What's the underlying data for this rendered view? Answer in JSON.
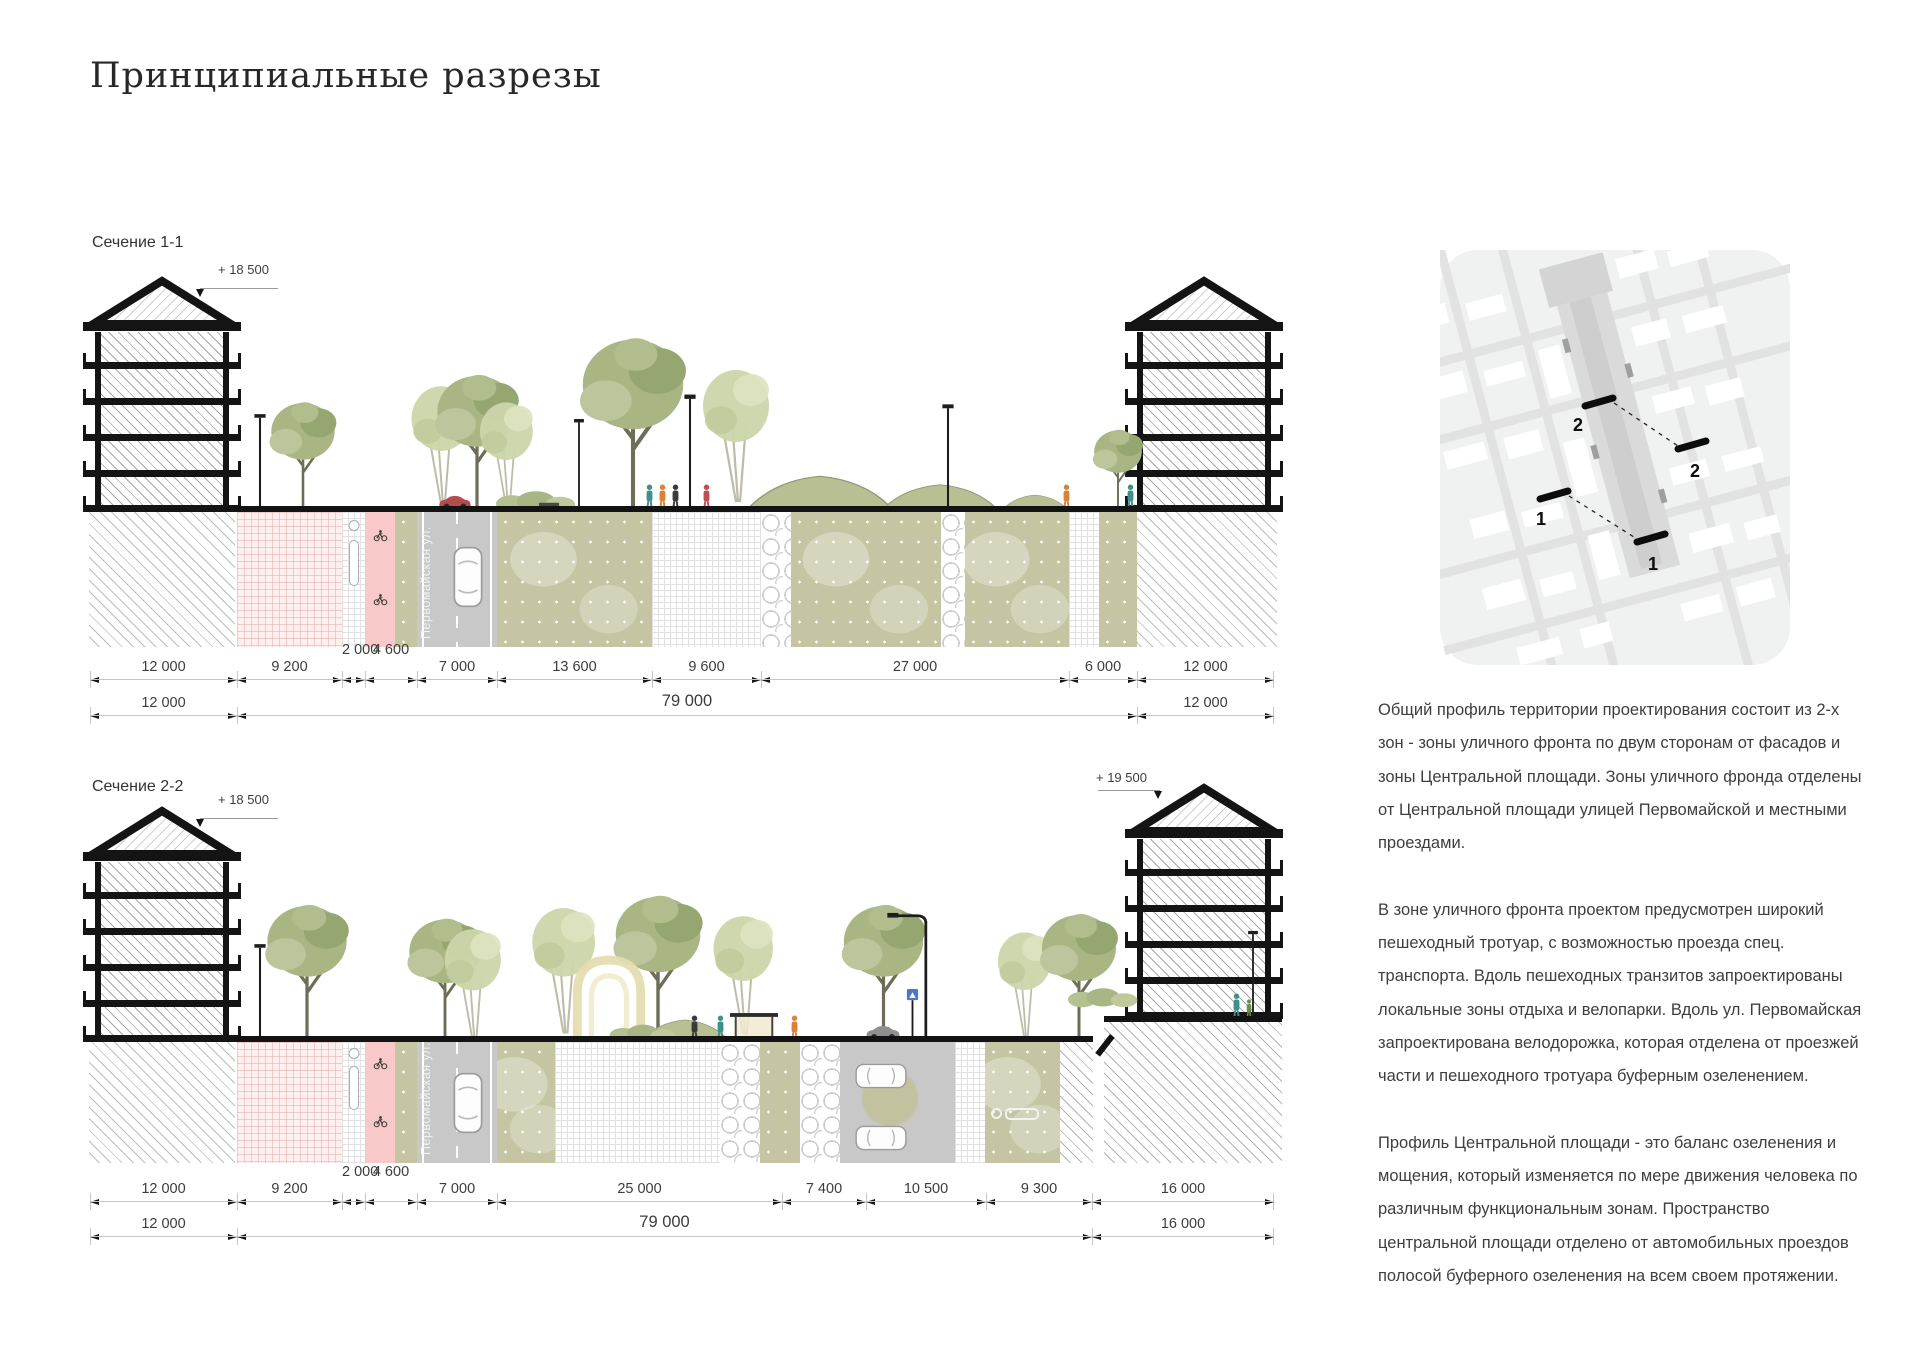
{
  "page": {
    "title": "Принципиальные разрезы"
  },
  "sections": [
    {
      "label": "Сечение 1-1",
      "elevation_left": "+ 18 500",
      "street_label": "Первомайская ул.",
      "dims_row1": [
        "12 000",
        "9 200",
        "2 000",
        "4 600",
        "7 000",
        "13 600",
        "9 600",
        "27 000",
        "6 000",
        "12 000"
      ],
      "dims_row2": [
        "12 000",
        "79 000",
        "12 000"
      ]
    },
    {
      "label": "Сечение 2-2",
      "elevation_left": "+ 18 500",
      "elevation_right": "+ 19 500",
      "street_label": "Первомайская ул.",
      "dims_row1": [
        "12 000",
        "9 200",
        "2 000",
        "4 600",
        "7 000",
        "25 000",
        "7 400",
        "10 500",
        "9 300",
        "16 000"
      ],
      "dims_row2": [
        "12 000",
        "79 000",
        "16 000"
      ]
    }
  ],
  "map": {
    "markers": [
      "2",
      "2",
      "1",
      "1"
    ]
  },
  "text": {
    "paragraphs": [
      "Общий профиль территории проектирования состоит из 2-х зон - зоны уличного фронта по двум сторонам от фасадов и зоны Центральной площади. Зоны уличного фронда отделены от Центральной площади улицей Первомайской и местными проездами.",
      "В зоне уличного фронта проектом предусмотрен широкий пешеходный тротуар, с возможностью проезда спец. транспорта. Вдоль пешеходных транзитов запроектированы локальные зоны отдыха и велопарки. Вдоль ул. Первомайская запроектирована велодорожка, которая отделена от проезжей части и пешеходного тротуара буферным озеленением.",
      "Профиль Центральной площади - это баланс озеленения и мощения, который изменяется по мере движения человека по различным функциональным зонам. Пространство центральной площади отделено от автомобильных проездов полосой буферного озеленения на всем своем протяжении."
    ]
  }
}
